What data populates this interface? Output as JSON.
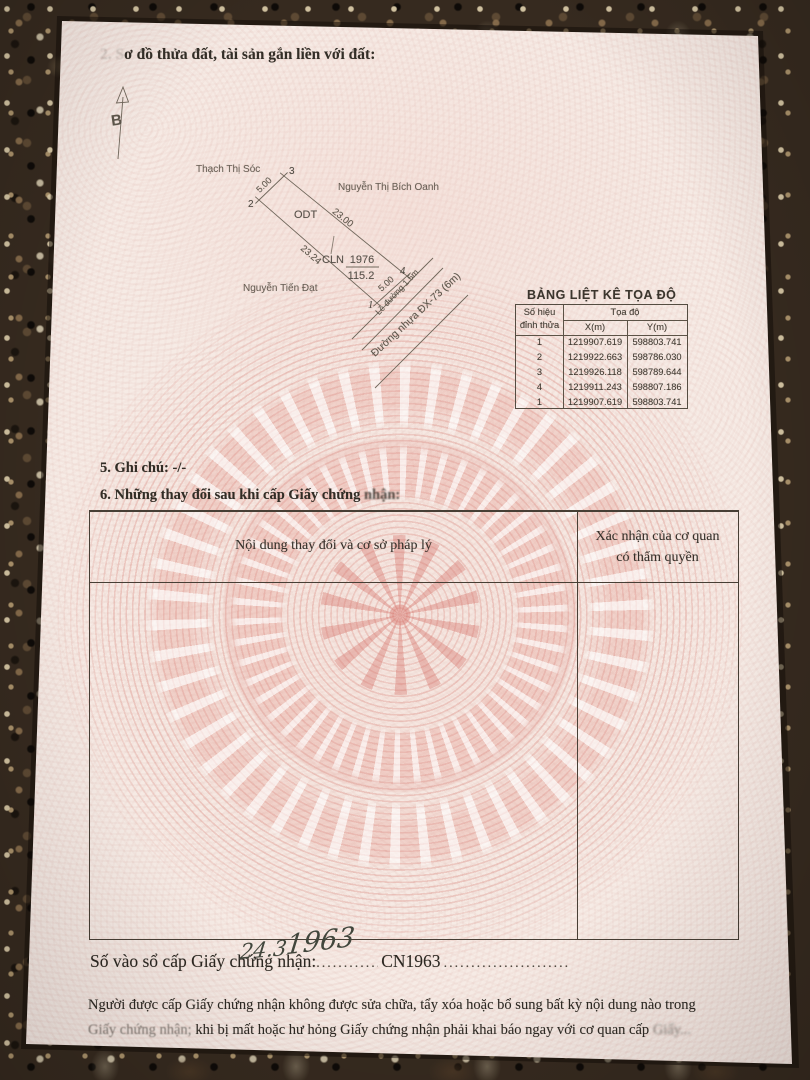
{
  "header": {
    "faded_prefix": "2. S",
    "title": "ơ đồ thửa đất, tài sản gắn liền với đất:"
  },
  "diagram": {
    "north": "B",
    "neighbor_top": "Thạch Thị Sóc",
    "neighbor_right": "Nguyễn Thị Bích Oanh",
    "neighbor_left": "Nguyễn Tiến Đạt",
    "land_use_1": "ODT",
    "land_use_2": "CLN",
    "parcel_number": "1976",
    "parcel_area": "115.2",
    "dim_top": "5.00",
    "dim_right": "23.00",
    "dim_left": "23.24",
    "dim_bottom": "5.00",
    "road_margin": "Lề đường 1.5m",
    "road_name": "Đường nhựa ĐX-73 (6m)",
    "v1": "1",
    "v2": "2",
    "v3": "3",
    "v4": "4"
  },
  "coord_table": {
    "title": "BẢNG LIỆT KÊ TỌA ĐỘ",
    "col_vertex_l1": "Số hiệu",
    "col_vertex_l2": "đỉnh thửa",
    "col_coords": "Tọa độ",
    "col_x": "X(m)",
    "col_y": "Y(m)",
    "rows": [
      {
        "id": "1",
        "x": "1219907.619",
        "y": "598803.741"
      },
      {
        "id": "2",
        "x": "1219922.663",
        "y": "598786.030"
      },
      {
        "id": "3",
        "x": "1219926.118",
        "y": "598789.644"
      },
      {
        "id": "4",
        "x": "1219911.243",
        "y": "598807.186"
      },
      {
        "id": "1",
        "x": "1219907.619",
        "y": "598803.741"
      }
    ]
  },
  "notes": {
    "item5": "5. Ghi chú: -/-",
    "item6_main": "6. Những thay đổi sau khi cấp Giấy chứng",
    "item6_smudge": " nhận:"
  },
  "changes_table": {
    "header_left": "Nội dung thay đổi và cơ sở pháp lý",
    "header_right_l1": "Xác nhận của cơ quan",
    "header_right_l2": "có thẩm quyền"
  },
  "registry": {
    "label": "Số vào sổ cấp Giấy chứng nhận:",
    "dots_left": "................................",
    "value": "CN1963",
    "dots_right": "............................................................",
    "handwriting_a": "24.3",
    "handwriting_b": "1963"
  },
  "footer": {
    "line1": "Người được cấp Giấy chứng nhận không được sửa chữa, tẩy xóa hoặc bổ sung bất kỳ nội dung nào trong",
    "line2_start": "Giấy chứng nhận;",
    "line2_main": " khi bị mất hoặc hư hỏng Giấy chứng nhận phải khai báo ngay với cơ quan cấp ",
    "line2_smudge": "Giấy..."
  }
}
